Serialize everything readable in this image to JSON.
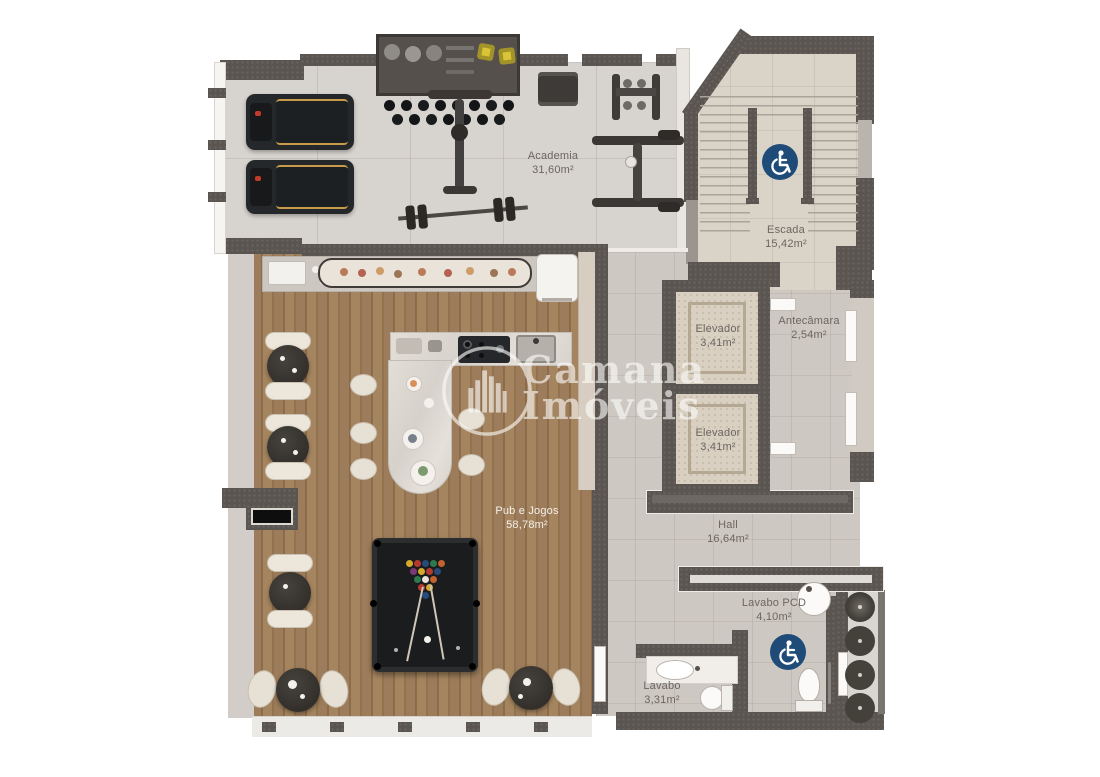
{
  "plan": {
    "watermark": {
      "line1": "Camana",
      "line2": "Imóveis"
    },
    "rooms": {
      "academia": {
        "name": "Academia",
        "area": "31,60m²"
      },
      "escada": {
        "name": "Escada",
        "area": "15,42m²"
      },
      "elevador_1": {
        "name": "Elevador",
        "area": "3,41m²"
      },
      "elevador_2": {
        "name": "Elevador",
        "area": "3,41m²"
      },
      "antecamara": {
        "name": "Antecâmara",
        "area": "2,54m²"
      },
      "hall": {
        "name": "Hall",
        "area": "16,64m²"
      },
      "pub": {
        "name": "Pub e Jogos",
        "area": "58,78m²"
      },
      "lavabo_pcd": {
        "name": "Lavabo PCD",
        "area": "4,10m²"
      },
      "lavabo": {
        "name": "Lavabo",
        "area": "3,31m²"
      }
    },
    "icons": {
      "accessibility": "wheelchair-accessibility-icon"
    },
    "colors": {
      "wall": "#5b5551",
      "wood_floor": "#9a7a58",
      "gym_floor": "#d7d3ce",
      "hall_floor": "#cdc8c2",
      "stairs_floor": "#d9d3c8",
      "accessible_blue": "#1e4b78",
      "accent_yellow": "#d9c437"
    }
  }
}
